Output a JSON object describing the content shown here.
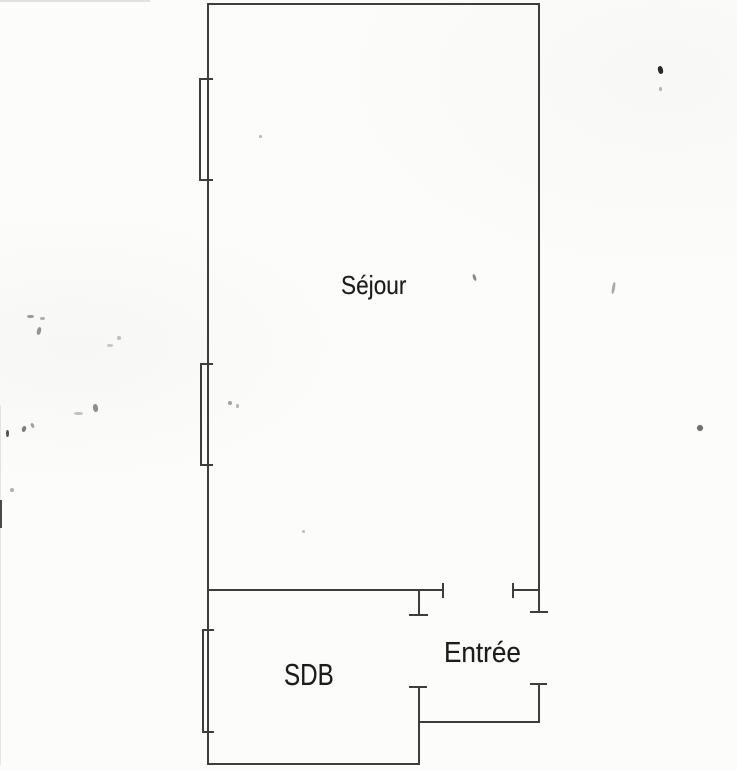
{
  "plan": {
    "type": "apartment-floor-plan",
    "rooms": [
      {
        "id": "sejour",
        "label": "Séjour"
      },
      {
        "id": "sdb",
        "label": "SDB"
      },
      {
        "id": "entree",
        "label": "Entrée"
      }
    ],
    "window_count": 3,
    "door_count": 3,
    "colors": {
      "background": "#fcfcfa",
      "wall_line": "#3d3d3d",
      "label_text": "#1c1c1c"
    }
  }
}
